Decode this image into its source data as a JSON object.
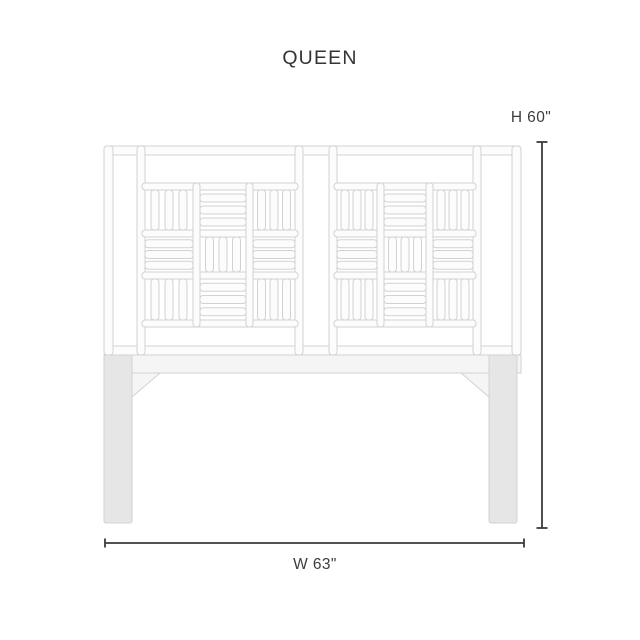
{
  "title": "QUEEN",
  "dimension_labels": {
    "height": "H 60\"",
    "width": "W 63\""
  },
  "drawing": {
    "subject": "headboard-front-view",
    "colors": {
      "outline": "#d2d2d2",
      "tube_fill": "#fcfcfc",
      "rail_fill": "#f5f5f5",
      "leg_fill": "#e6e6e6",
      "dimension": "#3a3a3a"
    },
    "fretwork": {
      "panels": 2,
      "rows": 3,
      "cols": 3,
      "slats_per_block": 3,
      "pattern": "alternating-vertical-horizontal"
    }
  }
}
